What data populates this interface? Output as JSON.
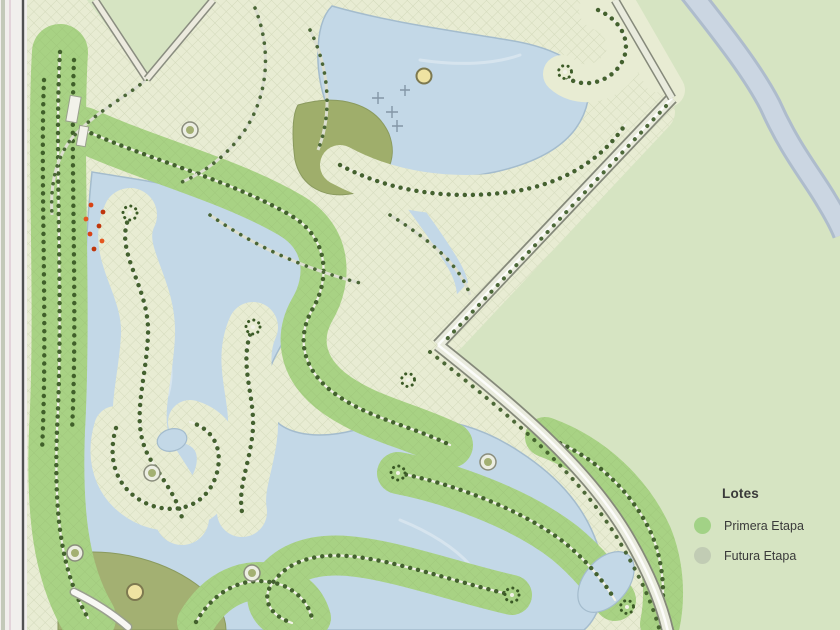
{
  "map": {
    "description": "Master plan of a residential lot development with lakes, tree-lined streets and a future expansion area",
    "legend": {
      "title": "Lotes",
      "items": [
        {
          "label": "Primera Etapa",
          "color": "#9ccf7f"
        },
        {
          "label": "Futura Etapa",
          "color": "#bfc9b3"
        }
      ]
    },
    "palette": {
      "future_area": "#d6e4c2",
      "lots_primera": "#a8d284",
      "lots_futura": "#e8ecd3",
      "water": "#c3d8e7",
      "river": "#c9d4e0",
      "park": "#a3b072",
      "road": "#ebece0",
      "trees": "#3b5a26",
      "border_line": "#515152",
      "amenity_marker": "#efe3a2",
      "location_marker": "#d84315"
    },
    "markers": {
      "amenity_markers_count": 2,
      "location_marker_dots_count": 7
    }
  }
}
